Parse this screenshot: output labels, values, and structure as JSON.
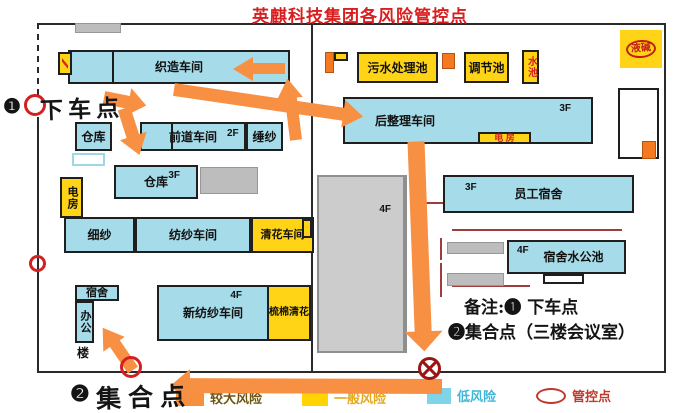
{
  "title": {
    "text": "英麒科技集团各风险管控点"
  },
  "colors": {
    "cyan": "#a6dce9",
    "yellow": "#ffd416",
    "orange_box": "#f4791f",
    "arrow": "#f79043",
    "gray": "#bdbdbd",
    "red": "#d42020",
    "title_red": "#d81e1e",
    "dark_red": "#9b1515"
  },
  "map": {
    "buildings": [
      {
        "name": "gray-roof",
        "label": "",
        "x": 75,
        "y": 23,
        "w": 46,
        "h": 10,
        "fill": "gray"
      },
      {
        "name": "weaving-workshop",
        "label": "织造车间",
        "x": 68,
        "y": 50,
        "w": 222,
        "h": 34,
        "fill": "cyan"
      },
      {
        "name": "weaving-tag",
        "label": "",
        "x": 58,
        "y": 52,
        "w": 14,
        "h": 23,
        "fill": "yellow",
        "slash": true
      },
      {
        "name": "warehouse-1",
        "label": "仓库",
        "x": 75,
        "y": 122,
        "w": 37,
        "h": 29,
        "fill": "cyan"
      },
      {
        "name": "white-shed",
        "label": "",
        "x": 72,
        "y": 153,
        "w": 33,
        "h": 13,
        "fill": "whiteCyan"
      },
      {
        "name": "front-process-workshop",
        "label": "前道车间",
        "floor": "2F",
        "floorPos": {
          "left": 85,
          "top": 5
        },
        "x": 140,
        "y": 122,
        "w": 106,
        "h": 29,
        "fill": "cyan"
      },
      {
        "name": "winding-room",
        "label": "缍纱",
        "x": 246,
        "y": 122,
        "w": 37,
        "h": 29,
        "fill": "cyan"
      },
      {
        "name": "power-room-left",
        "label": "电房",
        "x": 60,
        "y": 177,
        "w": 23,
        "h": 41,
        "fill": "yellow",
        "vertical": true,
        "fs": 11
      },
      {
        "name": "warehouse-2",
        "label": "仓库",
        "floor": "3F",
        "floorPos": {
          "right": 16,
          "top": 4
        },
        "x": 114,
        "y": 165,
        "w": 84,
        "h": 34,
        "fill": "cyan"
      },
      {
        "name": "gray-shed-1",
        "label": "",
        "x": 200,
        "y": 167,
        "w": 58,
        "h": 27,
        "fill": "gray"
      },
      {
        "name": "fine-yarn-room",
        "label": "细纱",
        "x": 64,
        "y": 217,
        "w": 71,
        "h": 36,
        "fill": "cyan"
      },
      {
        "name": "spinning-workshop",
        "label": "纺纱车间",
        "x": 135,
        "y": 217,
        "w": 116,
        "h": 36,
        "fill": "cyan"
      },
      {
        "name": "cleaning-workshop",
        "label": "清花车间",
        "x": 251,
        "y": 217,
        "w": 63,
        "h": 36,
        "fill": "yellow",
        "fs": 11
      },
      {
        "name": "yellow-kiosk",
        "label": "",
        "x": 302,
        "y": 219,
        "w": 10,
        "h": 19,
        "fill": "yellow"
      },
      {
        "name": "dorm-small",
        "label": "宿舍",
        "x": 75,
        "y": 285,
        "w": 44,
        "h": 16,
        "fill": "cyan",
        "fs": 11
      },
      {
        "name": "office-tower",
        "label": "办公",
        "x": 75,
        "y": 301,
        "w": 19,
        "h": 42,
        "fill": "cyan",
        "vertical": true,
        "fs": 11
      },
      {
        "name": "new-spinning-workshop",
        "label": "新纺纱车间",
        "floor": "4F",
        "floorPos": {
          "right": 25,
          "top": 4
        },
        "x": 157,
        "y": 285,
        "w": 112,
        "h": 56,
        "fill": "cyan"
      },
      {
        "name": "carding-cleaning",
        "label": "梳棉清花",
        "x": 267,
        "y": 285,
        "w": 44,
        "h": 56,
        "fill": "yellow",
        "fs": 10
      },
      {
        "name": "central-building",
        "label": "",
        "floor": "4F",
        "floorPos": {
          "right": 12,
          "top": 28
        },
        "x": 317,
        "y": 175,
        "w": 90,
        "h": 178,
        "fill": "grayBig"
      },
      {
        "name": "flag-pole",
        "label": "",
        "x": 325,
        "y": 52,
        "w": 9,
        "h": 21,
        "fill": "orange"
      },
      {
        "name": "flag-top",
        "label": "",
        "x": 334,
        "y": 52,
        "w": 14,
        "h": 9,
        "fill": "yellow"
      },
      {
        "name": "sewage-treatment-pool",
        "label": "污水处理池",
        "x": 357,
        "y": 52,
        "w": 81,
        "h": 31,
        "fill": "yellow"
      },
      {
        "name": "orange-kiosk-1",
        "label": "",
        "x": 442,
        "y": 53,
        "w": 13,
        "h": 16,
        "fill": "orange"
      },
      {
        "name": "regulating-pool",
        "label": "调节池",
        "x": 464,
        "y": 52,
        "w": 45,
        "h": 31,
        "fill": "yellow"
      },
      {
        "name": "water-pool",
        "label": "水池",
        "x": 522,
        "y": 50,
        "w": 17,
        "h": 34,
        "fill": "yellow",
        "vertical": true,
        "color": "#d42020",
        "fs": 10
      },
      {
        "name": "finishing-workshop",
        "label": "后整理车间",
        "floor": "3F",
        "floorPos": {
          "right": 20,
          "top": 5
        },
        "x": 343,
        "y": 97,
        "w": 250,
        "h": 47,
        "fill": "cyan",
        "align": "left",
        "padL": 30
      },
      {
        "name": "power-room-strip",
        "label": "电  房",
        "x": 478,
        "y": 132,
        "w": 53,
        "h": 12,
        "fill": "yellow",
        "color": "#d42020",
        "fs": 9
      },
      {
        "name": "staff-dormitory",
        "label": "员工宿舍",
        "floor": "3F",
        "floorPos": {
          "left": 20,
          "top": 6
        },
        "x": 443,
        "y": 175,
        "w": 191,
        "h": 38,
        "fill": "cyan"
      },
      {
        "name": "gray-bar-1",
        "label": "",
        "x": 447,
        "y": 242,
        "w": 57,
        "h": 12,
        "fill": "gray"
      },
      {
        "name": "gray-bar-2",
        "label": "",
        "x": 447,
        "y": 273,
        "w": 57,
        "h": 13,
        "fill": "gray"
      },
      {
        "name": "dorm-water-pool",
        "label": "宿舍水公池",
        "floor": "4F",
        "floorPos": {
          "left": 8,
          "top": 4
        },
        "x": 507,
        "y": 240,
        "w": 119,
        "h": 34,
        "fill": "cyan",
        "padL": 14
      },
      {
        "name": "outline-annex",
        "label": "",
        "x": 543,
        "y": 274,
        "w": 41,
        "h": 10,
        "fill": "outline"
      },
      {
        "name": "outline-building",
        "label": "",
        "x": 618,
        "y": 88,
        "w": 41,
        "h": 71,
        "fill": "outline"
      },
      {
        "name": "orange-kiosk-2",
        "label": "",
        "x": 642,
        "y": 141,
        "w": 14,
        "h": 18,
        "fill": "orange"
      }
    ],
    "texts": [
      {
        "name": "office-tower-suffix",
        "label": "楼",
        "x": 77,
        "y": 344,
        "fs": 12
      }
    ],
    "walls": [
      {
        "x": 37,
        "y": 23,
        "w": 629,
        "h": 2
      },
      {
        "x": 37,
        "y": 23,
        "w": 2,
        "h": 74,
        "dashed": true
      },
      {
        "x": 37,
        "y": 117,
        "w": 2,
        "h": 256
      },
      {
        "x": 37,
        "y": 371,
        "w": 629,
        "h": 2
      },
      {
        "x": 664,
        "y": 23,
        "w": 2,
        "h": 350
      },
      {
        "x": 311,
        "y": 23,
        "w": 2,
        "h": 349
      }
    ],
    "decor_black": [
      {
        "x": 112,
        "y": 52,
        "w": 2,
        "h": 30
      },
      {
        "x": 171,
        "y": 124,
        "w": 2,
        "h": 25
      }
    ],
    "decor_red": [
      {
        "x": 452,
        "y": 229,
        "w": 170,
        "h": 2
      },
      {
        "x": 452,
        "y": 285,
        "w": 78,
        "h": 2
      },
      {
        "x": 440,
        "y": 238,
        "w": 2,
        "h": 22
      },
      {
        "x": 440,
        "y": 263,
        "w": 2,
        "h": 34
      },
      {
        "x": 420,
        "y": 202,
        "w": 23,
        "h": 2
      }
    ],
    "arrows": [
      {
        "name": "route-into-weaving",
        "x1": 285,
        "y1": 68,
        "x2": 230,
        "y2": 68,
        "w": 11
      },
      {
        "name": "route-weaving-to-finishing",
        "x1": 174,
        "y1": 89,
        "x2": 366,
        "y2": 117,
        "w": 13
      },
      {
        "name": "route-up-to-weaving",
        "x1": 296,
        "y1": 140,
        "x2": 288,
        "y2": 75,
        "w": 12
      },
      {
        "name": "route-dropoff-1",
        "x1": 104,
        "y1": 97,
        "x2": 149,
        "y2": 106,
        "w": 13
      },
      {
        "name": "route-dropoff-2",
        "x1": 124,
        "y1": 108,
        "x2": 140,
        "y2": 158,
        "w": 13
      },
      {
        "name": "route-down-center",
        "x1": 416,
        "y1": 141,
        "x2": 424,
        "y2": 354,
        "w": 17
      },
      {
        "name": "route-bottom-to-assembly",
        "x1": 442,
        "y1": 386,
        "x2": 167,
        "y2": 385,
        "w": 15
      },
      {
        "name": "route-to-office",
        "x1": 133,
        "y1": 370,
        "x2": 102,
        "y2": 325,
        "w": 12
      }
    ],
    "gates": [
      {
        "name": "gate-dropoff",
        "x": 24,
        "y": 94,
        "d": 22
      },
      {
        "name": "gate-west",
        "x": 29,
        "y": 255,
        "d": 17
      },
      {
        "name": "gate-assembly",
        "x": 120,
        "y": 356,
        "d": 22
      }
    ],
    "no_exit": {
      "x": 417,
      "y": 356,
      "d": 25
    }
  },
  "annotations": {
    "dropoff": {
      "num": "❶",
      "label": "下车点"
    },
    "assembly": {
      "num": "❷",
      "label": "集合点"
    },
    "notes": {
      "line1": "备注:❶ 下车点",
      "line2": "❷集合点（三楼会议室）"
    },
    "alkali": {
      "label": "液碱"
    }
  },
  "legend": {
    "items": [
      {
        "name": "major-risk",
        "label": "较大风险",
        "swatch": "orange",
        "label_color": "#6b5510",
        "x": 176,
        "y": 391
      },
      {
        "name": "general-risk",
        "label": "一般风险",
        "swatch": "yellow",
        "label_color": "#e3a81c",
        "x": 302,
        "y": 391
      },
      {
        "name": "low-risk",
        "label": "低风险",
        "swatch": "cyan",
        "label_color": "#3fb6d8",
        "x": 427,
        "y": 388
      },
      {
        "name": "control-point",
        "label": "管控点",
        "swatch": "oval",
        "label_color": "#c0392b",
        "x": 536,
        "y": 388
      }
    ]
  }
}
